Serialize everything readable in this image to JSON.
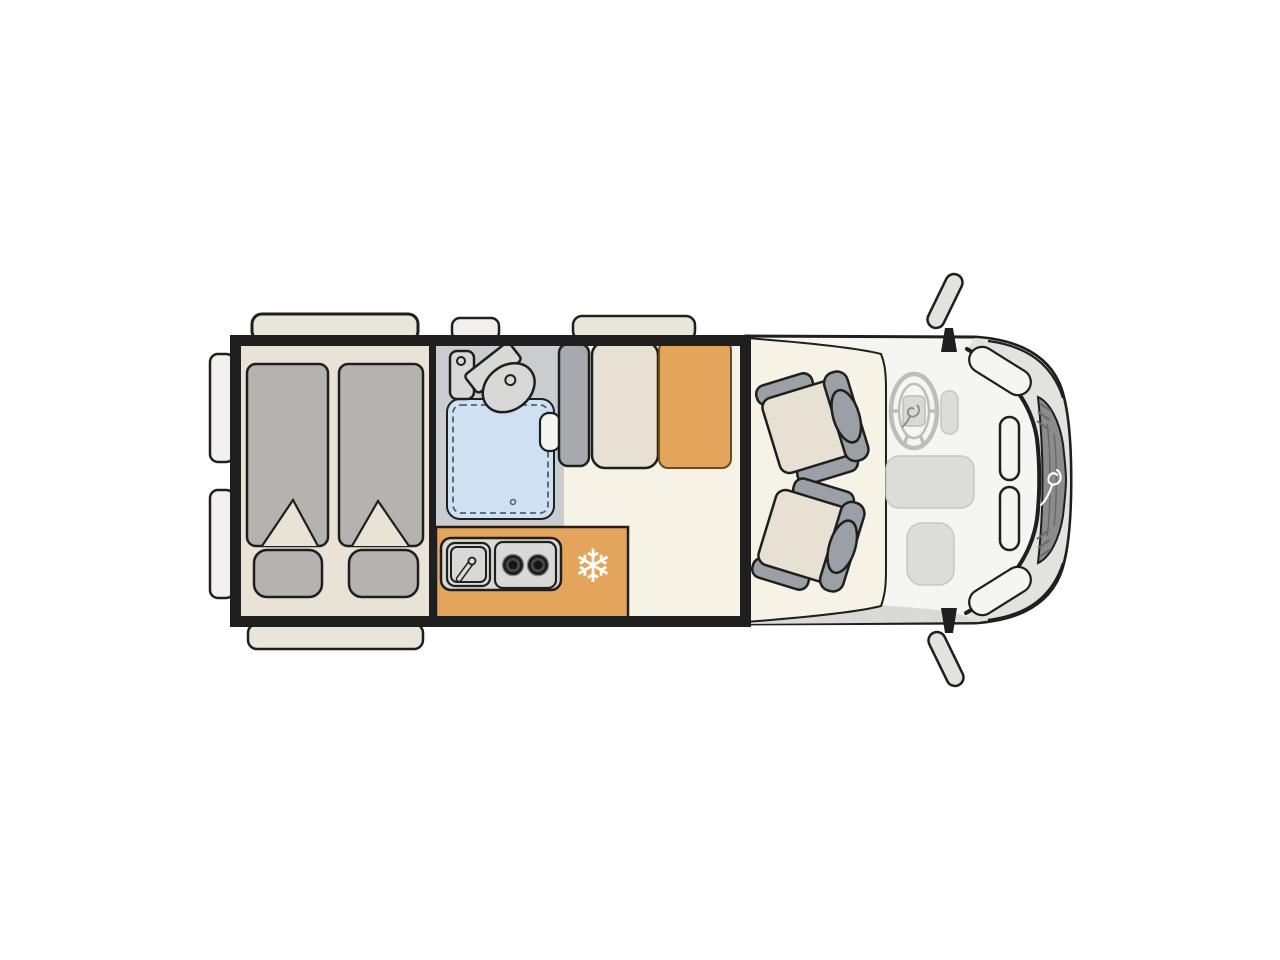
{
  "palette": {
    "background": "#ffffff",
    "outline": "#1f1f1f",
    "floor_cream": "#f6f2e5",
    "bed_beige": "#e9e3d6",
    "fabric_gray": "#b4b3b0",
    "bathroom_gray": "#c9cdd2",
    "shower_blue": "#cfe0f2",
    "shower_dash": "#47627e",
    "fixture_gray": "#d8d8d6",
    "wardrobe_gray": "#a6aaae",
    "upholstery_beige": "#e7e1d3",
    "seat_trim_gray": "#9aa0a5",
    "wood_orange": "#e3a55c",
    "table_edge": "#6b4a20",
    "counter_gray": "#dad9d7",
    "burner_ring": "#8a8a8a",
    "burner_dark": "#4a4a4a",
    "burner_core": "#161616",
    "cab_body": "#f5f5f2",
    "hood_gray": "#e2e2e0",
    "grille_gray": "#8c8c8c",
    "grille_line": "#6a6a6a",
    "sill_gray": "#d9d9d7",
    "dash_gray": "#dcdcda",
    "dash_edge": "#c6c6c4",
    "steering_gray": "#bdbdbd",
    "mirror_gray": "#e2e2e0",
    "window_beige": "#eae5d9",
    "door_white": "#f1f0ec",
    "brand_white": "#ffffff",
    "snowflake_white": "#ffffff"
  },
  "icons": {
    "snowflake_glyph": "❄"
  },
  "floorplan": {
    "view": "campervan-top-view",
    "zones": [
      "rear-twin-beds",
      "bathroom-shower-toilet",
      "wardrobe",
      "kitchen-sink-hob-fridge",
      "dinette-bench-table",
      "cab-two-swivel-seats"
    ],
    "bed_count": 2,
    "hob_burner_count": 2,
    "cab_seat_count": 2
  }
}
